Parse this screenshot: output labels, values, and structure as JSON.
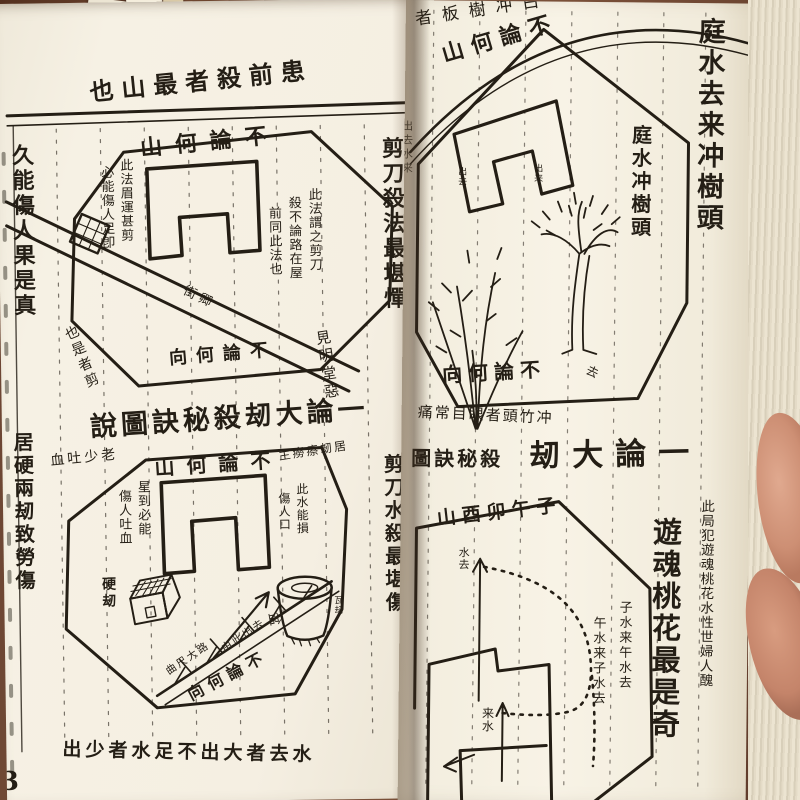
{
  "left_page": {
    "top_heading": "也山最者殺前患",
    "left_column": "久能傷人果是真",
    "right_column": "剪刀殺法最堪憚",
    "octagon1": {
      "top_edge": "山何論不",
      "bottom_edge": "向何論不",
      "note_left_a": "此法眉運甚剪",
      "note_left_b": "必能傷人足卽",
      "note_right_a": "此法謂之剪刀",
      "note_right_b": "殺不論路在屋",
      "note_right_c": "前同此法也",
      "road_label": "街卿",
      "corner_left": "也是者剪",
      "corner_right": "見明堂惡"
    },
    "section_heading": "說圖訣秘殺刼大論一",
    "octagon2": {
      "top_edge": "山何論不",
      "bottom_edge": "向何論不",
      "label_above": "血吐少老",
      "label_right": "主癆瘵刼居",
      "note_a": "星到必能",
      "note_b": "傷人吐血",
      "note_c": "此水能損",
      "note_d": "傷人口",
      "hard_house_label": "硬刼",
      "basin_label": "盆",
      "basin_side_label": "瓦刼",
      "thorn_road_label": "曲尺大路",
      "exit_road_label": "由此出去"
    },
    "left_column2": "居硬兩刼致勞傷",
    "right_column2": "剪刀水殺最堪傷",
    "bottom_caption": "出少者水足不出大者去水",
    "page_number": "3"
  },
  "right_page": {
    "top_cutoff": "者板樹冲白",
    "right_column_large": "庭水去来冲樹頭",
    "octagon": {
      "top_edge": "山何論不",
      "bottom_edge": "向何論不",
      "edge_column": "庭水冲樹頭",
      "spine_column": "出去水来",
      "plant_label": "出去",
      "tree_label": "出来",
      "corner_label": "去"
    },
    "caption_below": "痛常目眼者頭竹冲",
    "section_heading_small": "圖訣秘殺",
    "section_heading_large": "刼大論一",
    "lower": {
      "compass_row": "山酉卯午子",
      "water_out_label": "水去",
      "water_in_label": "来水",
      "water_right_column": "子水来午水去",
      "water_left_column": "午水来子水去",
      "big_column": "遊魂桃花最是奇",
      "small_column": "此局犯遊魂桃花水性世婦人醜"
    }
  }
}
